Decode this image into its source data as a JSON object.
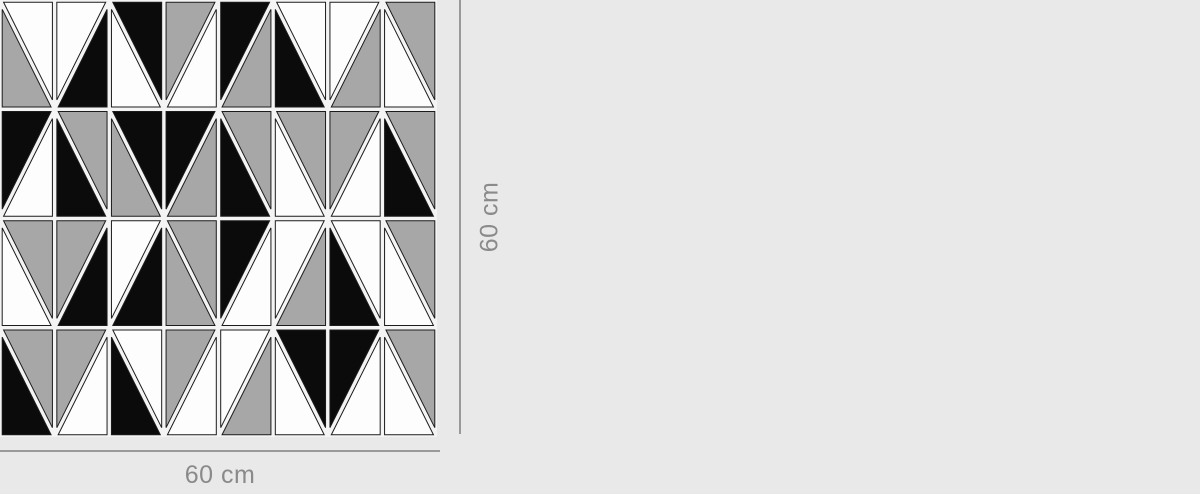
{
  "canvas": {
    "background": "#e9e9e9"
  },
  "pattern": {
    "cols": 8,
    "rows": 4,
    "size_px": 437,
    "gap_px": 2.2,
    "palette": {
      "black": "#0b0b0b",
      "white": "#fdfdfd",
      "gray": "#a7a7a7",
      "outline": "#1c1c1c",
      "gutter": "#f4f4f4"
    },
    "cells": [
      [
        {
          "diag": "tlbr",
          "upper": "white",
          "lower": "gray"
        },
        {
          "diag": "bltr",
          "upper": "white",
          "lower": "black"
        },
        {
          "diag": "tlbr",
          "upper": "black",
          "lower": "white"
        },
        {
          "diag": "bltr",
          "upper": "gray",
          "lower": "white"
        },
        {
          "diag": "bltr",
          "upper": "black",
          "lower": "gray"
        },
        {
          "diag": "tlbr",
          "upper": "white",
          "lower": "black"
        },
        {
          "diag": "bltr",
          "upper": "white",
          "lower": "gray"
        },
        {
          "diag": "tlbr",
          "upper": "gray",
          "lower": "white"
        }
      ],
      [
        {
          "diag": "bltr",
          "upper": "black",
          "lower": "white"
        },
        {
          "diag": "tlbr",
          "upper": "gray",
          "lower": "black"
        },
        {
          "diag": "tlbr",
          "upper": "black",
          "lower": "gray"
        },
        {
          "diag": "bltr",
          "upper": "black",
          "lower": "gray"
        },
        {
          "diag": "tlbr",
          "upper": "gray",
          "lower": "black"
        },
        {
          "diag": "tlbr",
          "upper": "gray",
          "lower": "white"
        },
        {
          "diag": "bltr",
          "upper": "gray",
          "lower": "white"
        },
        {
          "diag": "tlbr",
          "upper": "gray",
          "lower": "black"
        }
      ],
      [
        {
          "diag": "tlbr",
          "upper": "gray",
          "lower": "white"
        },
        {
          "diag": "bltr",
          "upper": "gray",
          "lower": "black"
        },
        {
          "diag": "bltr",
          "upper": "white",
          "lower": "black"
        },
        {
          "diag": "tlbr",
          "upper": "gray",
          "lower": "gray"
        },
        {
          "diag": "bltr",
          "upper": "black",
          "lower": "white"
        },
        {
          "diag": "bltr",
          "upper": "white",
          "lower": "gray"
        },
        {
          "diag": "tlbr",
          "upper": "white",
          "lower": "black"
        },
        {
          "diag": "tlbr",
          "upper": "gray",
          "lower": "white"
        }
      ],
      [
        {
          "diag": "tlbr",
          "upper": "gray",
          "lower": "black"
        },
        {
          "diag": "bltr",
          "upper": "gray",
          "lower": "white"
        },
        {
          "diag": "tlbr",
          "upper": "white",
          "lower": "black"
        },
        {
          "diag": "bltr",
          "upper": "gray",
          "lower": "white"
        },
        {
          "diag": "bltr",
          "upper": "white",
          "lower": "gray"
        },
        {
          "diag": "tlbr",
          "upper": "black",
          "lower": "white"
        },
        {
          "diag": "bltr",
          "upper": "black",
          "lower": "white"
        },
        {
          "diag": "tlbr",
          "upper": "gray",
          "lower": "white"
        }
      ]
    ]
  },
  "dimensions": {
    "width_label": "60 cm",
    "height_label": "60 cm",
    "line_color": "#9a9a9a",
    "text_color": "#8a8a8a"
  }
}
